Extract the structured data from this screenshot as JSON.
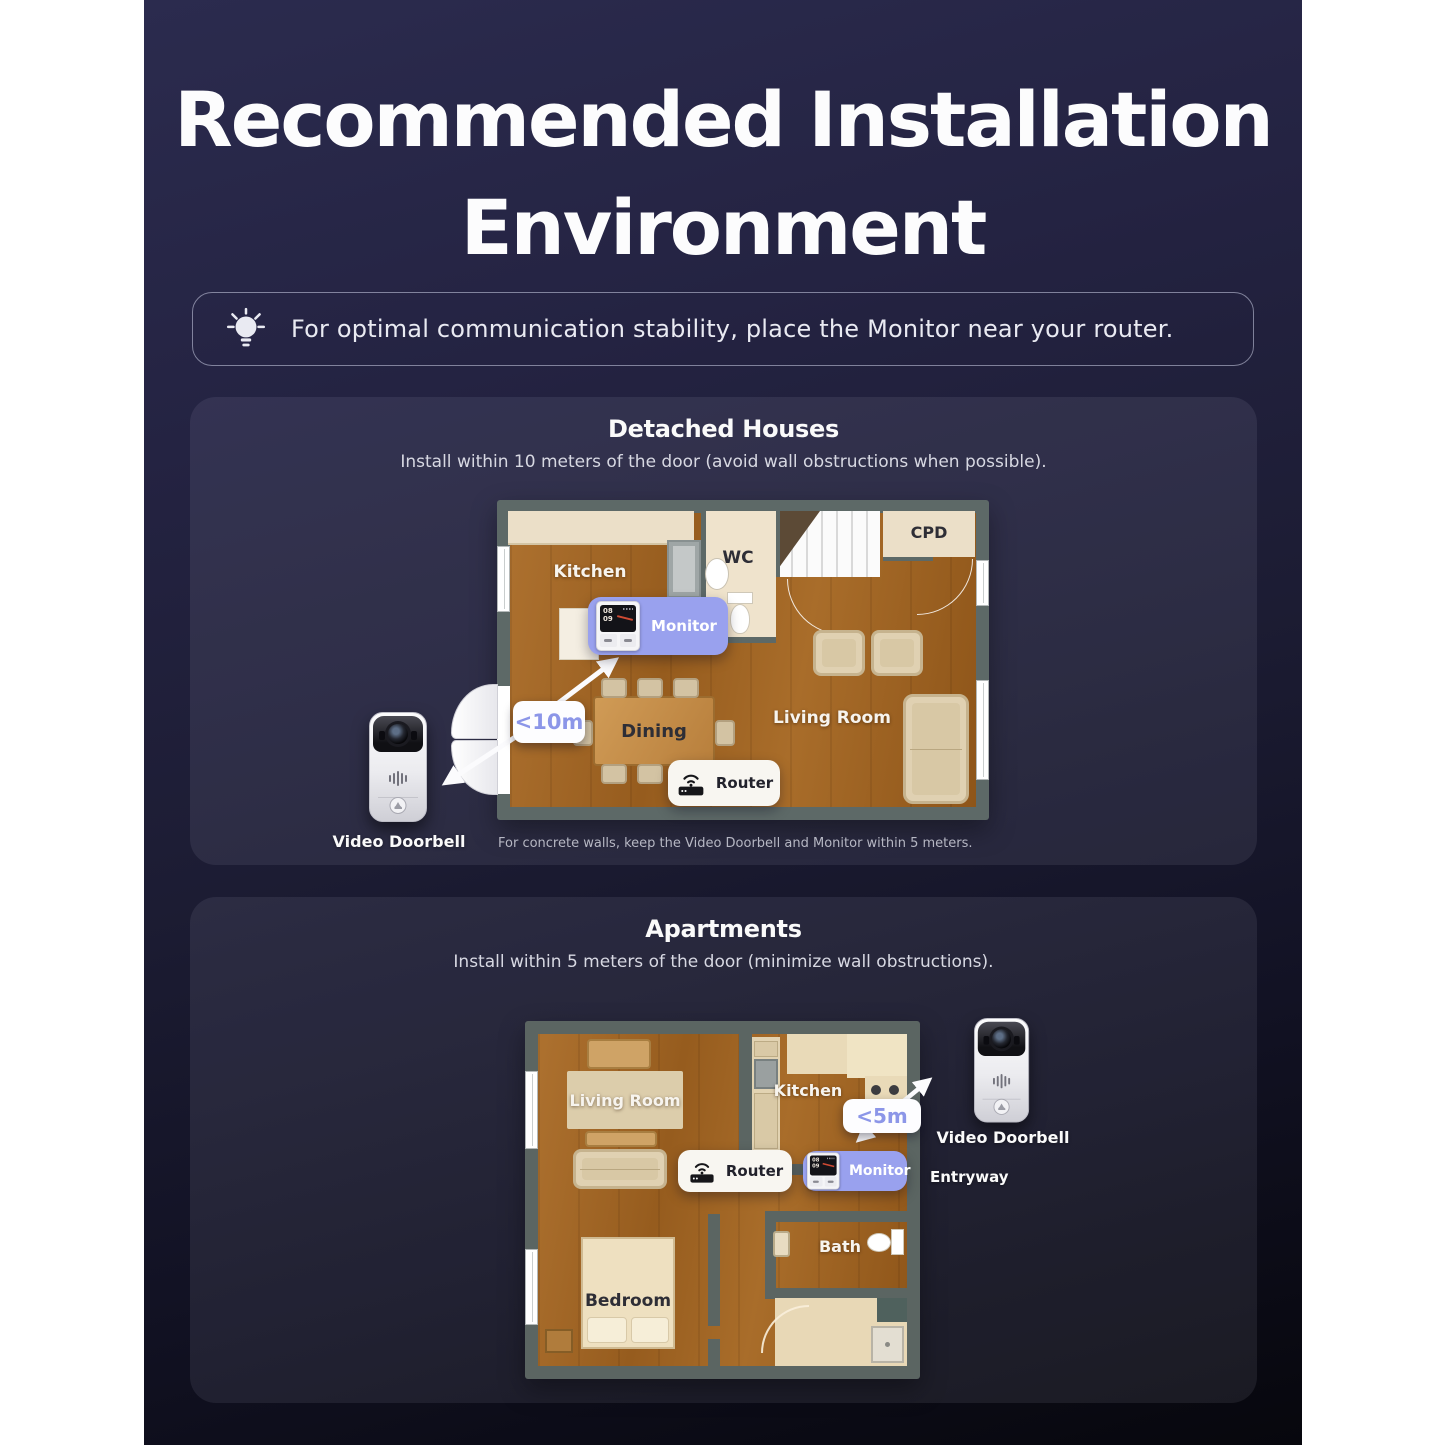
{
  "title": {
    "line1": "Recommended Installation",
    "line2": "Environment"
  },
  "tip": {
    "text": "For optimal communication stability,  place the Monitor near your router."
  },
  "sections": {
    "detached": {
      "title": "Detached Houses",
      "subtitle": "Install within 10 meters of the door (avoid wall obstructions when possible).",
      "distance": "<10m",
      "monitor": "Monitor",
      "router": "Router",
      "doorbell": "Video Doorbell",
      "note": "For concrete walls, keep the Video Doorbell and Monitor within 5 meters.",
      "rooms": {
        "kitchen": "Kitchen",
        "wc": "WC",
        "cpd": "CPD",
        "dining": "Dining",
        "living": "Living Room"
      }
    },
    "apartments": {
      "title": "Apartments",
      "subtitle": "Install within 5 meters of the door (minimize wall obstructions).",
      "distance": "<5m",
      "monitor": "Monitor",
      "router": "Router",
      "doorbell": "Video Doorbell",
      "entryway": "Entryway",
      "rooms": {
        "living": "Living Room",
        "kitchen": "Kitchen",
        "bedroom": "Bedroom",
        "bath": "Bath"
      }
    }
  },
  "monitor_screen": {
    "hour": "08",
    "minute": "09"
  },
  "colors": {
    "accent_lavender": "#99a1ee",
    "distance_text": "#8c96e8",
    "wall_gray": "#5d6967",
    "floor_wood": "#9d6322",
    "background_top": "#2b2b4e",
    "background_bottom": "#07070d"
  }
}
